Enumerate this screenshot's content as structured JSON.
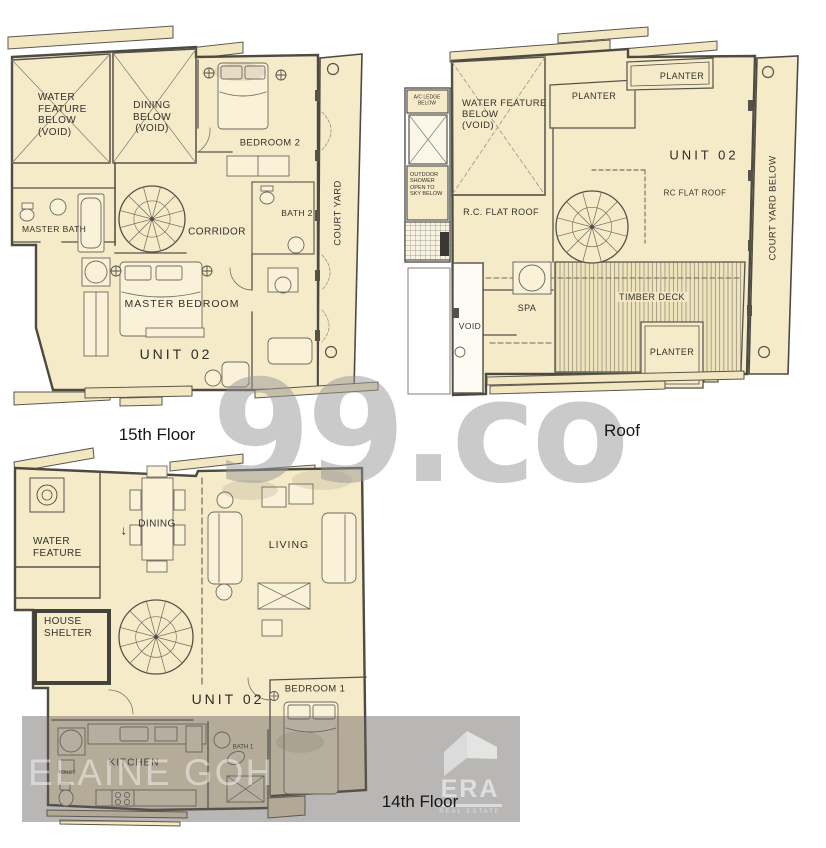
{
  "watermarks": {
    "brand": "99.co",
    "agent": "ELAINE GOH",
    "era_title": "ERA",
    "era_subtitle": "REAL ESTATE"
  },
  "colors": {
    "plan_fill": "#f6ebc9",
    "wall": "#4d4a42",
    "watermark_gray": "#cfcfcf",
    "band_gray": "rgba(95,92,88,0.44)"
  },
  "floor15": {
    "caption": "15th Floor",
    "labels": {
      "water_feature": "WATER\nFEATURE\nBELOW\n(VOID)",
      "dining_below": "DINING\nBELOW\n(VOID)",
      "bedroom2": "BEDROOM 2",
      "master_bath": "MASTER BATH",
      "corridor": "CORRIDOR",
      "bath2": "BATH 2",
      "master_bedroom": "MASTER BEDROOM",
      "unit": "UNIT 02",
      "court_yard": "COURT YARD"
    }
  },
  "roof": {
    "caption": "Roof",
    "labels": {
      "ac_ledge": "A/C LEDGE\nBELOW",
      "water_feature": "WATER FEATURE\nBELOW\n(VOID)",
      "outdoor_shower": "OUTDOOR\nSHOWER\nOPEN TO\nSKY BELOW",
      "rc_flat_roof_left": "R.C. FLAT ROOF",
      "planter_top": "PLANTER",
      "planter_right": "PLANTER",
      "planter_bottom": "PLANTER",
      "unit": "UNIT 02",
      "rc_flat_roof_right": "RC FLAT ROOF",
      "spa": "SPA",
      "void": "VOID",
      "timber_deck": "TIMBER DECK",
      "court_yard_below": "COURT YARD BELOW"
    }
  },
  "floor14": {
    "caption": "14th Floor",
    "labels": {
      "water_feature": "WATER\nFEATURE",
      "dining": "DINING",
      "arrow": "↓",
      "living": "LIVING",
      "house_shelter": "HOUSE\nSHELTER",
      "unit": "UNIT 02",
      "bedroom1": "BEDROOM 1",
      "kitchen": "KITCHEN",
      "toilet": "TOILET",
      "bath1": "BATH 1"
    }
  }
}
